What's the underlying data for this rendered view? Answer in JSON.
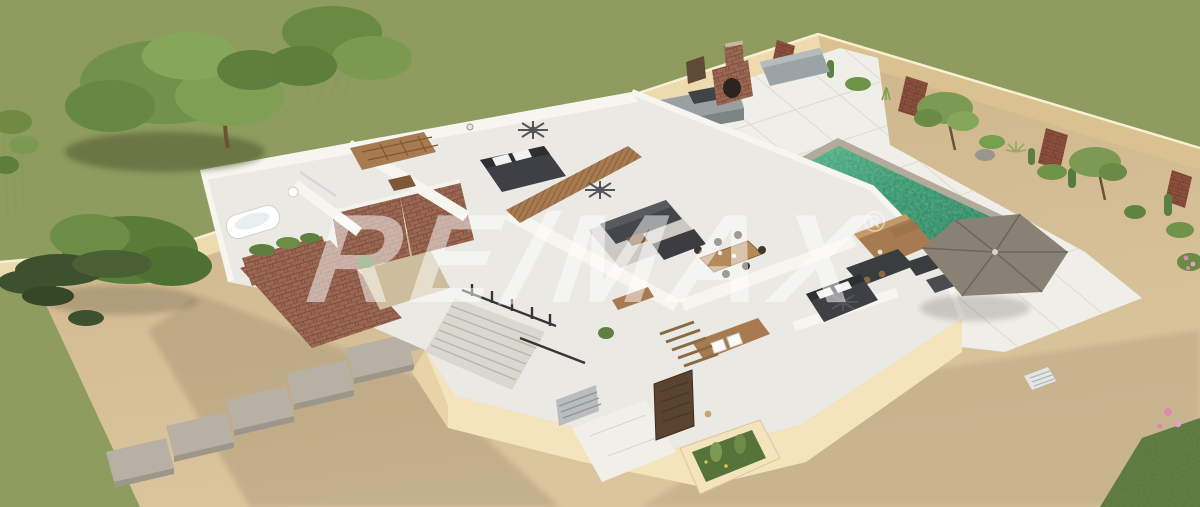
{
  "watermark": {
    "brand": "RE/MAX",
    "registered": "®"
  },
  "colors": {
    "grass": "#8d9a5d",
    "grassDark": "#76854a",
    "sand": "#d3bc93",
    "sandLight": "#dcc7a0",
    "wall": "#eddaaf",
    "wallShade": "#d9c190",
    "deck": "#efeee8",
    "tile": "#d8d4c8",
    "pool": "#2e8a63",
    "poolLight": "#3fae7c",
    "coping": "#b2ab9c",
    "brick": "#9a6753",
    "brickDark": "#7d4f3d",
    "wood": "#a87a50",
    "woodDark": "#7c5836",
    "cream": "#f3e4bc",
    "creamShade": "#e7d3a5",
    "charcoal": "#3f4046",
    "gray": "#9aa0a2",
    "umbrella": "#8a8175",
    "foliage": "#72914a",
    "foliageDark": "#5a7c39",
    "white": "#f7f5ef",
    "stone": "#b7b1a5",
    "watermark": "#ffffff"
  },
  "scene": {
    "description": "Aerial 3D cutaway render of a walled single-story villa",
    "areas": [
      "lawn",
      "perimeter wall with brick accents",
      "swimming pool",
      "white tile pool deck",
      "outdoor kitchen with brick oven",
      "patio umbrella",
      "sun loungers",
      "master bedroom",
      "walk-in closet",
      "bathroom",
      "brick atrium courtyard",
      "living room",
      "dining area",
      "kitchen",
      "second bedroom",
      "utility room",
      "entry staircase",
      "front door",
      "cactus planters",
      "stepping-stone walkway",
      "trees and shrubs"
    ]
  }
}
